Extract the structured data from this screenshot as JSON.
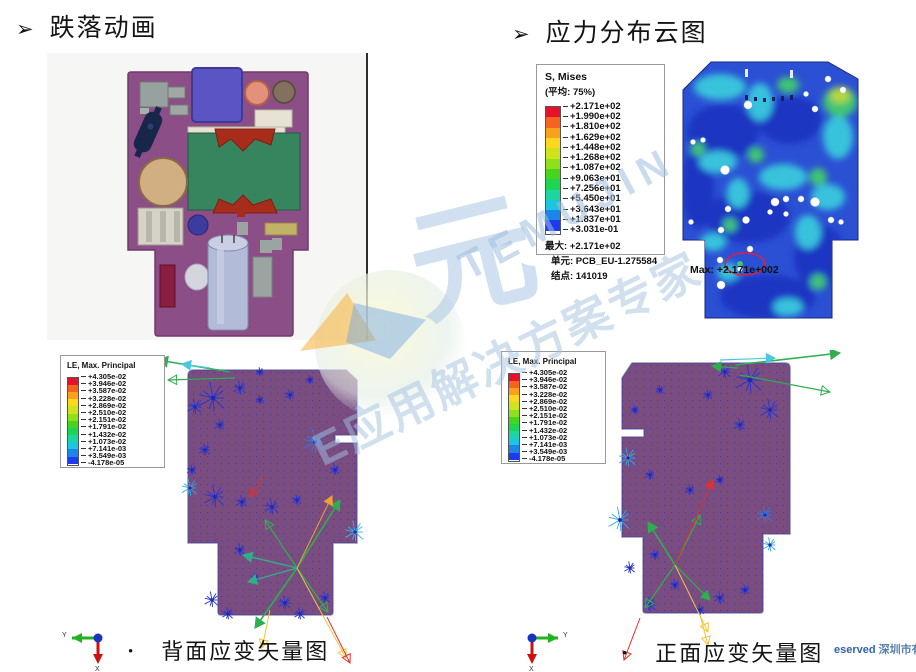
{
  "slide": {
    "bullet_glyph": "➢",
    "title_left": "跌落动画",
    "title_right": "应力分布云图",
    "caption_bullet": "•",
    "caption_left": "背面应变矢量图",
    "caption_right": "正面应变矢量图",
    "footer": "eserved ",
    "footer_cn": "深圳市有限"
  },
  "watermark": {
    "brand": "TEMUJIN",
    "cn_char": "元",
    "tagline": "E应用解决方案专家"
  },
  "spectrum": [
    "#e8112d",
    "#f4641e",
    "#f9a11b",
    "#ffd71e",
    "#cfe31c",
    "#8ee01c",
    "#46d51c",
    "#1cd553",
    "#1cd5a0",
    "#1cc6e0",
    "#1c86e8",
    "#1c3af0"
  ],
  "stress_legend": {
    "title": "S, Mises",
    "subtitle": "(平均: 75%)",
    "values": [
      "+2.171e+02",
      "+1.990e+02",
      "+1.810e+02",
      "+1.629e+02",
      "+1.448e+02",
      "+1.268e+02",
      "+1.087e+02",
      "+9.063e+01",
      "+7.256e+01",
      "+5.450e+01",
      "+3.643e+01",
      "+1.837e+01",
      "+3.031e-01"
    ],
    "max_line": "最大: +2.171e+02",
    "elem_line": "单元: PCB_EU-1.275584",
    "node_line": "结点: 141019"
  },
  "strain_legend": {
    "title": "LE, Max. Principal",
    "values": [
      "+4.305e-02",
      "+3.946e-02",
      "+3.587e-02",
      "+3.228e-02",
      "+2.869e-02",
      "+2.510e-02",
      "+2.151e-02",
      "+1.791e-02",
      "+1.432e-02",
      "+1.073e-02",
      "+7.141e-03",
      "+3.549e-03",
      "-4.178e-05"
    ]
  },
  "contour": {
    "max_annotation": "Max: +2.171e+002"
  },
  "axes": {
    "y_label": "Y",
    "x_label": "X"
  }
}
